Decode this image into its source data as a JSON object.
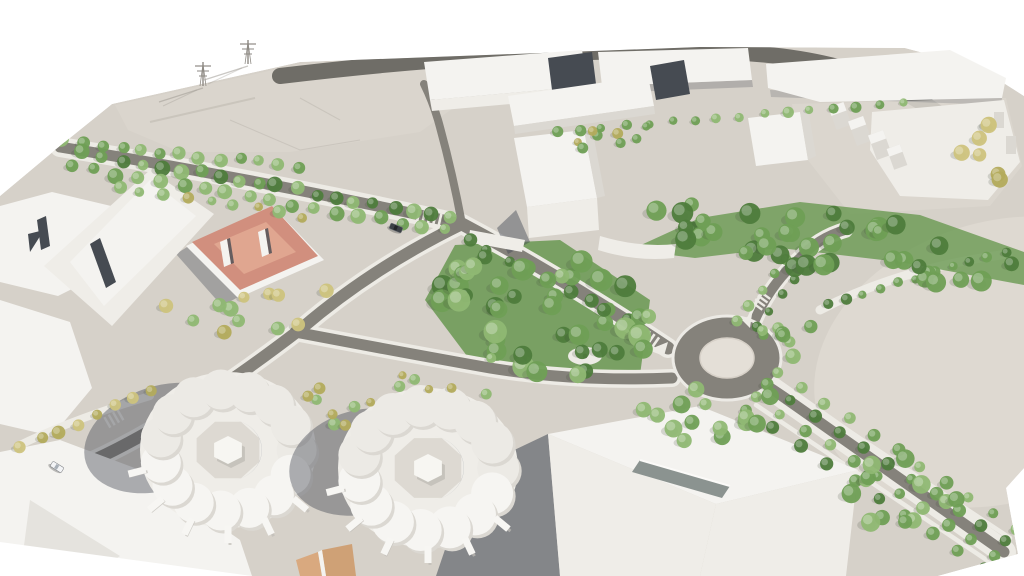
{
  "meta": {
    "description": "Aerial 3D architectural rendering of an urban masterplan: white massing buildings, a tree-lined boulevard, a central roundabout with formal avenue, a dense central park grove, two circular courtyard apartment buildings, a terracotta-roofed villa and a large open plaza"
  },
  "palette": {
    "bg": "#ffffff",
    "ground": "#d6d1c9",
    "field": "#dad5cd",
    "plaza": "#ded9d1",
    "campus": "#dcd7cf",
    "road": "#85827b",
    "roadDark": "#6f6d67",
    "walk": "#edebe5",
    "island": "#e4dfd7",
    "bTop": "#f4f3f0",
    "bLit": "#efede8",
    "bShade": "#dbd8d2",
    "bDark": "#c0bdb7",
    "slit": "#464b52",
    "terra": "#d18f7e",
    "terraHi": "#e0a690",
    "tan1": "#d9a97f",
    "tan2": "#cfa176",
    "shadow": "#424854",
    "parkBase": "#699851",
    "treeGreen": "#6f9f55",
    "treeGreenLight": "#8fb873",
    "treeGreenDark": "#4e7c3c",
    "treeYellow": "#b3ab5c",
    "treeYellowLight": "#cec37d",
    "carDark": "#3c4046",
    "carLight": "#f3f4f6",
    "pylon": "#8e8a84"
  },
  "scene": {
    "seed": 7,
    "tree_rows": [
      {
        "from": [
          64,
          141
        ],
        "to": [
          298,
          167
        ],
        "n": 13,
        "r": [
          5,
          8
        ],
        "colors": [
          "treeGreen",
          "treeGreenLight"
        ],
        "j": 3
      },
      {
        "from": [
          84,
          153
        ],
        "to": [
          452,
          217
        ],
        "n": 20,
        "r": [
          5,
          8
        ],
        "colors": [
          "treeGreen",
          "treeGreenLight",
          "treeGreenDark"
        ],
        "j": 3
      },
      {
        "from": [
          74,
          167
        ],
        "to": [
          446,
          230
        ],
        "n": 18,
        "r": [
          5,
          8
        ],
        "colors": [
          "treeGreen",
          "treeGreenLight"
        ],
        "j": 3
      },
      {
        "from": [
          118,
          186
        ],
        "to": [
          302,
          216
        ],
        "n": 9,
        "r": [
          4,
          7
        ],
        "colors": [
          "treeYellow",
          "treeGreenLight"
        ],
        "j": 3
      },
      {
        "from": [
          556,
          131
        ],
        "to": [
          902,
          104
        ],
        "n": 16,
        "r": [
          4,
          6
        ],
        "colors": [
          "treeGreen",
          "treeGreenLight"
        ],
        "j": 2
      },
      {
        "from": [
          468,
          240
        ],
        "to": [
          630,
          320
        ],
        "n": 9,
        "r": [
          5,
          8
        ],
        "colors": [
          "treeGreen",
          "treeGreenDark"
        ],
        "j": 3
      },
      {
        "from": [
          778,
          372
        ],
        "to": [
          1016,
          530
        ],
        "n": 11,
        "r": [
          5,
          7
        ],
        "colors": [
          "treeGreen",
          "treeGreenLight"
        ],
        "j": 2
      },
      {
        "from": [
          768,
          384
        ],
        "to": [
          1006,
          542
        ],
        "n": 11,
        "r": [
          5,
          7
        ],
        "colors": [
          "treeGreen",
          "treeGreenDark"
        ],
        "j": 2
      },
      {
        "from": [
          758,
          398
        ],
        "to": [
          996,
          556
        ],
        "n": 11,
        "r": [
          5,
          7
        ],
        "colors": [
          "treeGreen",
          "treeGreenLight"
        ],
        "j": 2
      },
      {
        "from": [
          748,
          410
        ],
        "to": [
          986,
          568
        ],
        "n": 10,
        "r": [
          5,
          7
        ],
        "colors": [
          "treeGreen",
          "treeGreenDark"
        ],
        "j": 2
      },
      {
        "from": [
          736,
          320
        ],
        "to": [
          786,
          258
        ],
        "n": 5,
        "r": [
          4,
          6
        ],
        "colors": [
          "treeGreen",
          "treeGreenLight"
        ],
        "j": 2
      },
      {
        "from": [
          756,
          326
        ],
        "to": [
          806,
          264
        ],
        "n": 5,
        "r": [
          4,
          6
        ],
        "colors": [
          "treeGreen",
          "treeGreenDark"
        ],
        "j": 2
      },
      {
        "from": [
          828,
          304
        ],
        "to": [
          1006,
          252
        ],
        "n": 11,
        "r": [
          4,
          6
        ],
        "colors": [
          "treeGreenDark",
          "treeGreen"
        ],
        "j": 2
      },
      {
        "from": [
          22,
          448
        ],
        "to": [
          150,
          390
        ],
        "n": 8,
        "r": [
          5,
          7
        ],
        "colors": [
          "treeYellow",
          "treeYellowLight"
        ],
        "j": 3
      }
    ],
    "tree_clusters": [
      {
        "c": [
          545,
          312
        ],
        "rx": 108,
        "ry": 62,
        "rot": 14,
        "n": 44,
        "r": [
          7,
          12
        ],
        "colors": [
          "treeGreenDark",
          "treeGreen",
          "treeGreenLight"
        ]
      },
      {
        "c": [
          840,
          243
        ],
        "rx": 198,
        "ry": 32,
        "rot": 7,
        "n": 40,
        "r": [
          7,
          11
        ],
        "colors": [
          "treeGreenDark",
          "treeGreen"
        ]
      },
      {
        "c": [
          705,
          414
        ],
        "rx": 72,
        "ry": 30,
        "rot": -10,
        "n": 14,
        "r": [
          6,
          9
        ],
        "colors": [
          "treeGreen",
          "treeGreenLight"
        ]
      },
      {
        "c": [
          900,
          482
        ],
        "rx": 62,
        "ry": 50,
        "rot": 0,
        "n": 12,
        "r": [
          7,
          10
        ],
        "colors": [
          "treeGreen",
          "treeGreenLight"
        ]
      },
      {
        "c": [
          246,
          308
        ],
        "rx": 95,
        "ry": 28,
        "rot": -8,
        "n": 12,
        "r": [
          5,
          8
        ],
        "colors": [
          "treeYellow",
          "treeYellowLight",
          "treeGreenLight"
        ]
      },
      {
        "c": [
          332,
          404
        ],
        "rx": 36,
        "ry": 26,
        "rot": 0,
        "n": 7,
        "r": [
          5,
          7
        ],
        "colors": [
          "treeYellow",
          "treeGreenLight"
        ]
      },
      {
        "c": [
          432,
          382
        ],
        "rx": 88,
        "ry": 28,
        "rot": -5,
        "n": 8,
        "r": [
          4,
          6
        ],
        "colors": [
          "treeYellow",
          "treeGreenLight"
        ]
      },
      {
        "c": [
          986,
          152
        ],
        "rx": 36,
        "ry": 42,
        "rot": 0,
        "n": 7,
        "r": [
          6,
          9
        ],
        "colors": [
          "treeYellow",
          "treeYellowLight"
        ]
      },
      {
        "c": [
          602,
          140
        ],
        "rx": 58,
        "ry": 13,
        "rot": -8,
        "n": 8,
        "r": [
          4,
          6
        ],
        "colors": [
          "treeGreen",
          "treeYellow"
        ]
      },
      {
        "c": [
          802,
          332
        ],
        "rx": 40,
        "ry": 26,
        "rot": 0,
        "n": 8,
        "r": [
          5,
          8
        ],
        "colors": [
          "treeGreen",
          "treeGreenLight"
        ]
      }
    ],
    "circular_buildings": [
      {
        "c": [
          228,
          450
        ],
        "rx": 88,
        "ry": 78,
        "lobes": 15,
        "lobeR": 20,
        "courtR": 34,
        "shadow": {
          "c": [
            162,
            438
          ],
          "rx": 80,
          "ry": 52,
          "rot": -18
        },
        "fins": [
          40,
          65,
          90,
          115,
          140,
          165
        ],
        "finLen": 15
      },
      {
        "c": [
          428,
          468
        ],
        "rx": 90,
        "ry": 80,
        "lobes": 15,
        "lobeR": 21,
        "courtR": 36,
        "shadow": {
          "c": [
            362,
            462
          ],
          "rx": 74,
          "ry": 52,
          "rot": -15
        },
        "fins": [
          40,
          65,
          90,
          115,
          140,
          165
        ],
        "finLen": 15
      }
    ],
    "cars": [
      {
        "x": 396,
        "y": 228,
        "rot": 22,
        "body": "carDark"
      },
      {
        "x": 57,
        "y": 467,
        "rot": 32,
        "body": "carLight"
      }
    ],
    "pylons": [
      {
        "x": 203,
        "y": 86
      },
      {
        "x": 248,
        "y": 64
      }
    ]
  }
}
